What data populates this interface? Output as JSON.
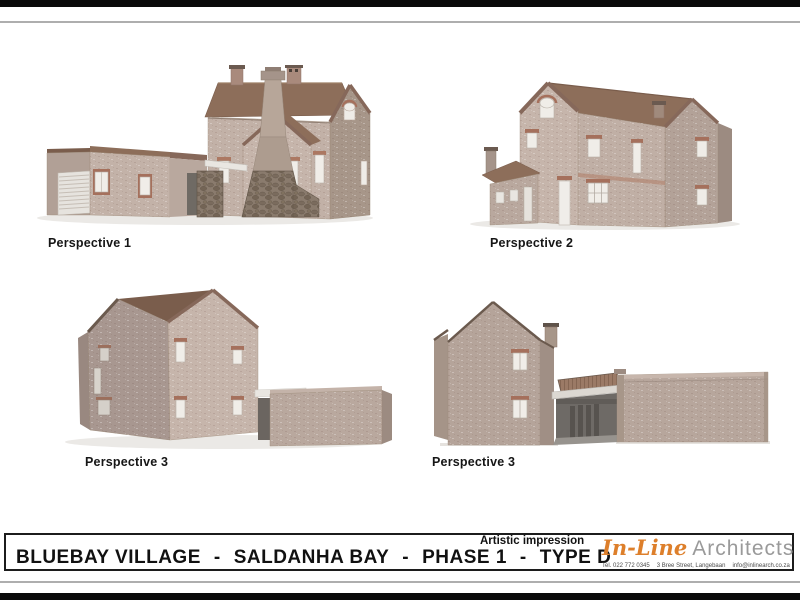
{
  "renderings": [
    {
      "label": "Perspective 1"
    },
    {
      "label": "Perspective 2"
    },
    {
      "label": "Perspective 3"
    },
    {
      "label": "Perspective 3"
    }
  ],
  "title_block": {
    "annotation": "Artistic impression",
    "segments": [
      "BLUEBAY VILLAGE",
      "SALDANHA BAY",
      "PHASE 1",
      "TYPE D"
    ],
    "separator": "-",
    "logo": {
      "part1": "In-Line",
      "part2": "Architects"
    },
    "contact": {
      "tel": "Tel. 022 772 0345",
      "address": "3 Bree Street, Langebaan",
      "email": "info@inlinearch.co.za"
    }
  },
  "colors": {
    "wall_lit": "#c4b3a9",
    "wall_mid": "#b7a69c",
    "wall_shadow": "#a69588",
    "roof_brown": "#8d6e5a",
    "stone": "#8a7b6d",
    "window": "#f0ede8",
    "lintel_brick": "#a5705c",
    "logo_orange": "#dd7f2b",
    "logo_gray": "#9a9a9a",
    "frame_black": "#0a0a0a"
  }
}
